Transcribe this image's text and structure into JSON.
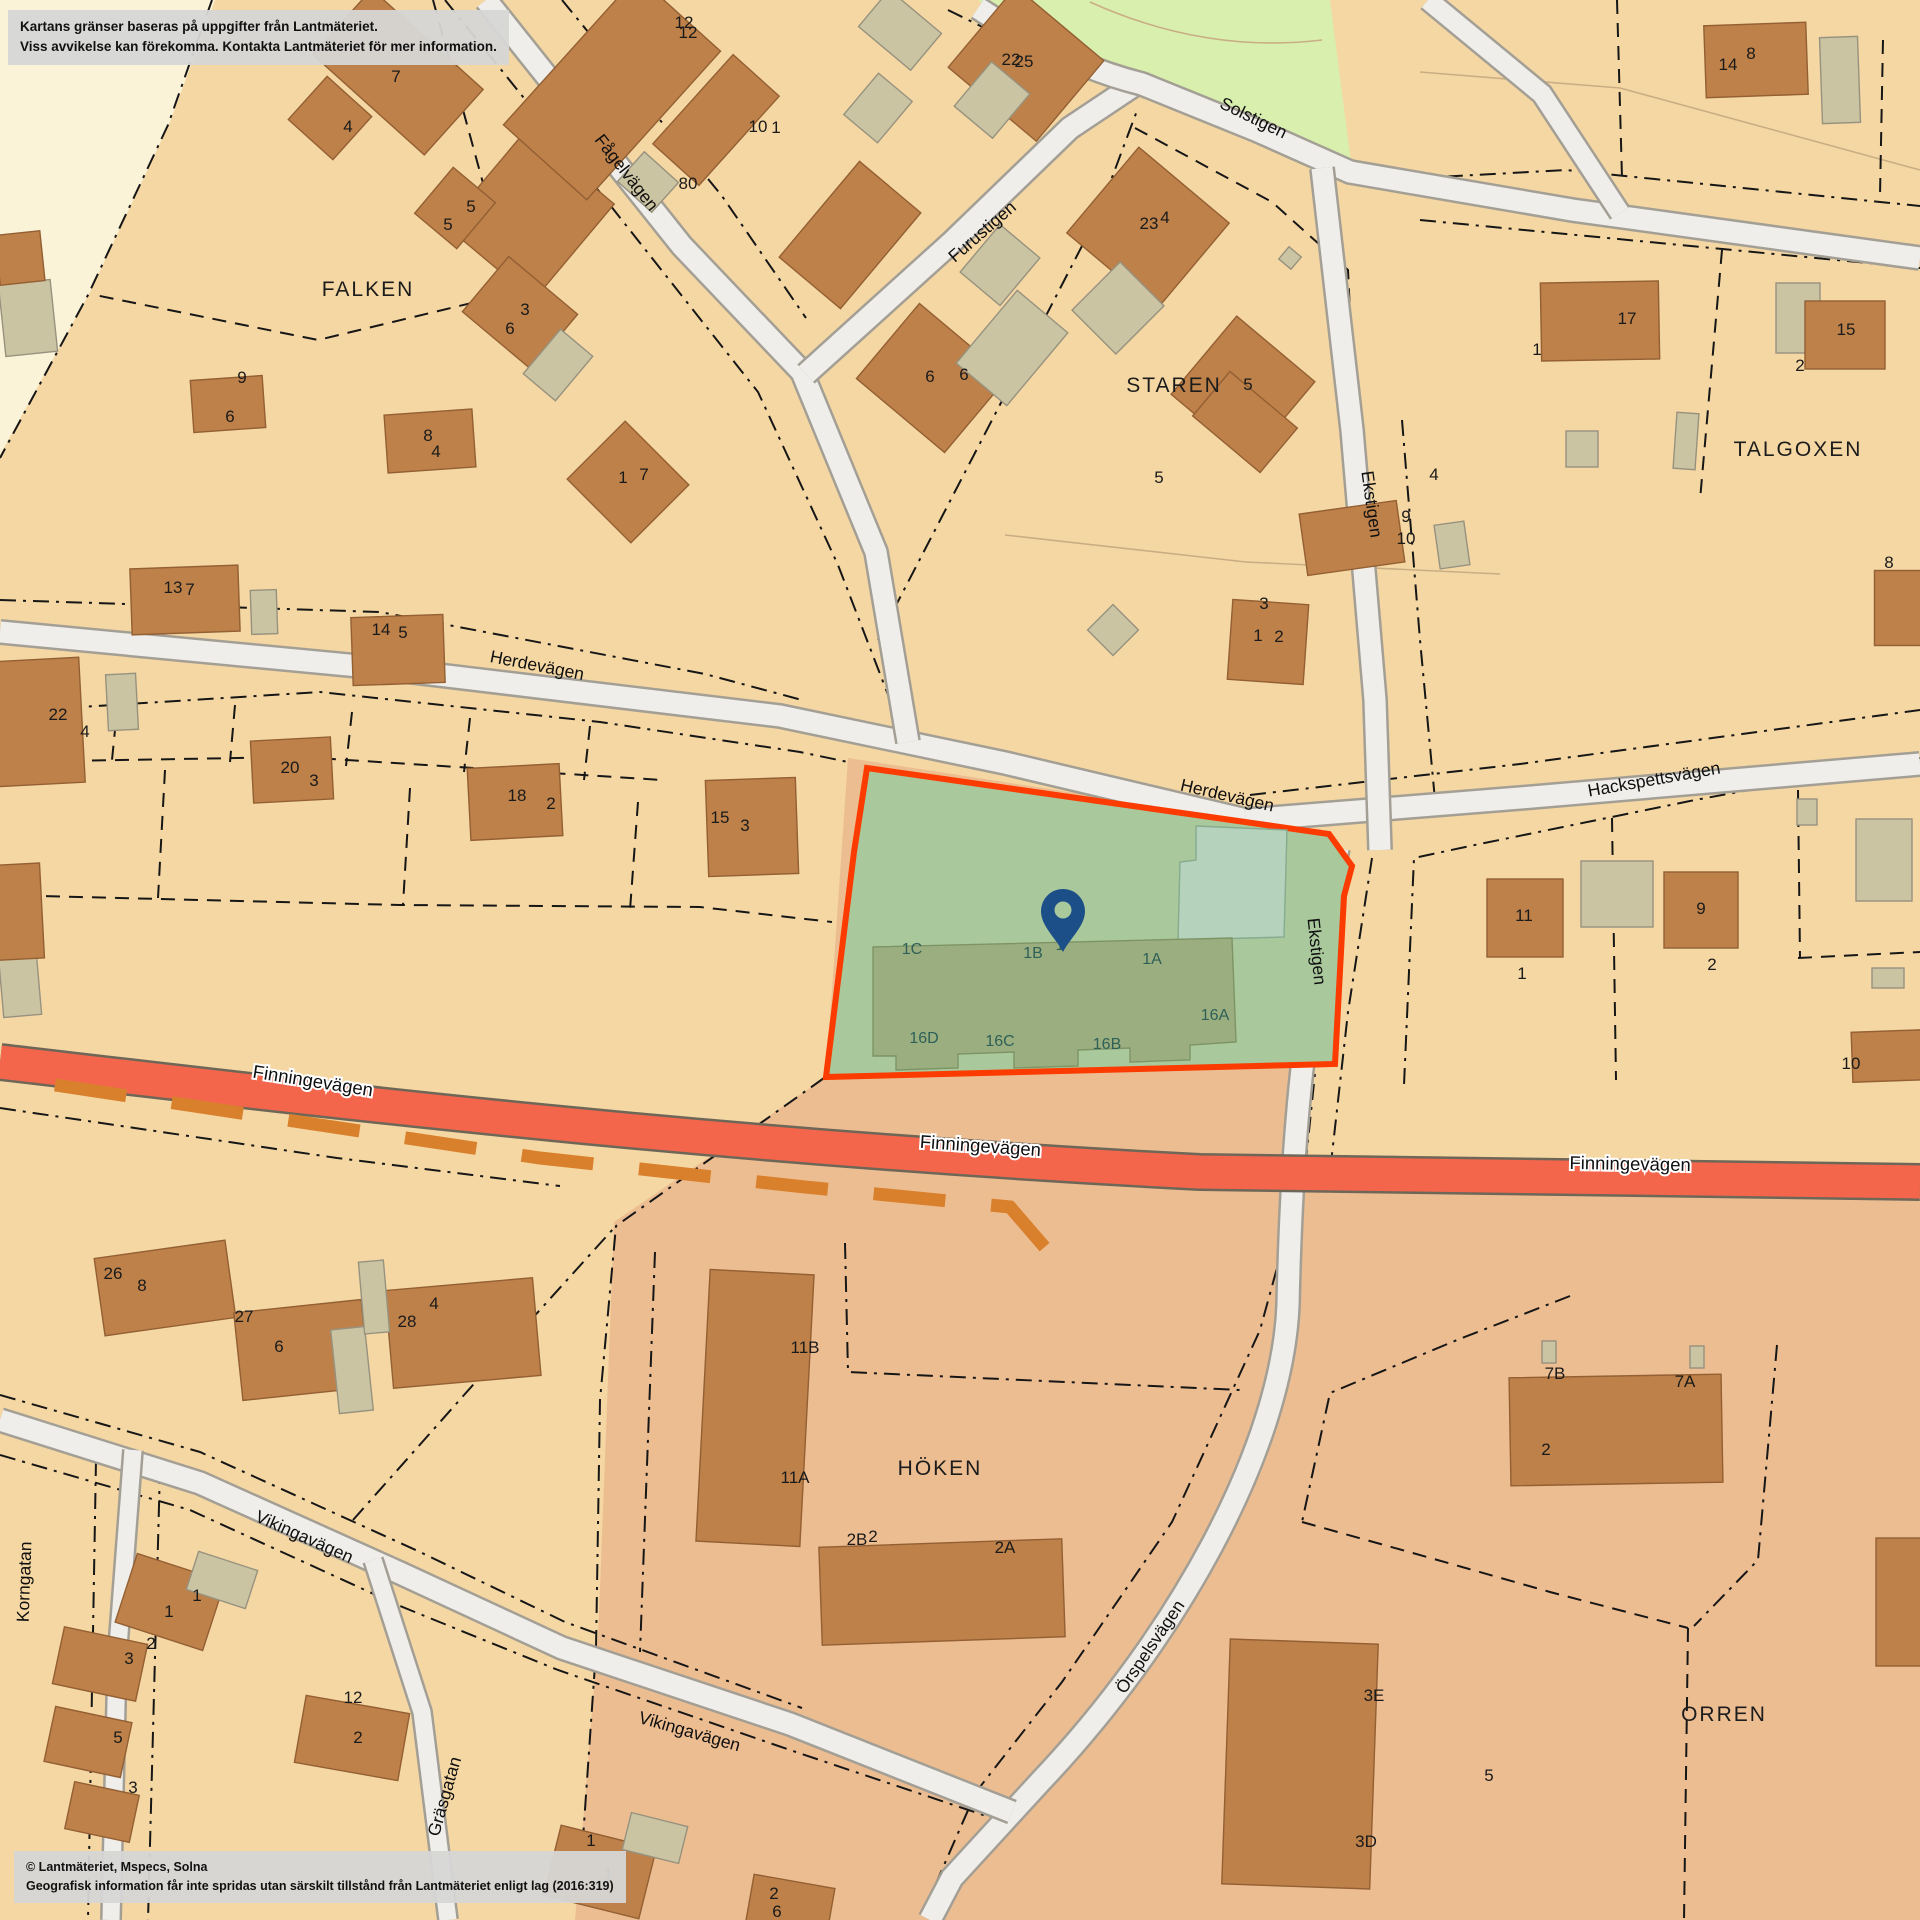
{
  "overlays": {
    "disclaimer_line1": "Kartans gränser baseras på uppgifter från Lantmäteriet.",
    "disclaimer_line2": "Viss avvikelse kan förekomma. Kontakta Lantmäteriet för mer information.",
    "copyright_line1": "© Lantmäteriet, Mspecs, Solna",
    "copyright_line2": "Geografisk information får inte spridas utan särskilt tillstånd från Lantmäteriet enligt lag (2016:319)"
  },
  "colors": {
    "tan": "#f5d7a3",
    "cream": "#fbf3d8",
    "park": "#d9efad",
    "salmon": "#edbd92",
    "parcel_green": "#a9c89c",
    "teal": "#b5d2bd",
    "subject_building": "#9aae80",
    "subject_building_stroke": "#7e9465",
    "orange_border": "#fb3b00",
    "house": "#bd8149",
    "house_stroke": "#935f33",
    "shed": "#cac4a2",
    "shed_stroke": "#97927f",
    "road_fill": "#efeeeb",
    "road_casing": "#a49f95",
    "finninge_fill": "#f3664c",
    "finninge_casing": "#6e6758",
    "trail": "#d9802c",
    "boundary": "#161616",
    "thin_line": "#c9ae85",
    "pin": "#1c4e88"
  },
  "regions": [
    {
      "name": "cream-area",
      "d": "M0,0 L215,0 L170,122 L90,292 L0,455 Z",
      "fill": "cream"
    },
    {
      "name": "park-area",
      "d": "M978,0 L1330,0 L1352,170 L1260,132 L1145,86 Q1040,55 978,0 Z",
      "fill": "park"
    },
    {
      "name": "salmon-area",
      "d": "M848,758 L1160,806 L1235,878 L1290,1010 L1308,1160 L1920,1176 L1920,1920 L575,1920 L598,1640 L614,1222 L826,1077 Z",
      "fill": "salmon"
    }
  ],
  "thin_lines": [
    {
      "d": "M1090,2 Q1205,54 1322,40"
    },
    {
      "d": "M1005,535 L1246,562 L1500,574"
    },
    {
      "d": "M1420,72 L1620,88 L1920,170"
    }
  ],
  "boundaries_dashdot": [
    "M212,0 L168,125 L88,295 L0,458",
    "M445,0 L610,205 L758,392 L838,565 L892,705",
    "M562,0 L722,196 L806,318",
    "M0,600 L380,612 L705,674 L802,700",
    "M0,712 L320,692 L600,722 L800,752 L848,762",
    "M806,368 L950,240 L1068,126",
    "M878,640 L1005,395 L1098,215 L1138,108",
    "M948,10 L1058,64 L1146,94 L1256,140 L1348,182",
    "M1348,182 L1566,170 L1920,206",
    "M1420,220 L1920,268",
    "M1322,178 L1348,430 L1370,700 L1378,842",
    "M1402,420 L1420,640 L1435,800",
    "M1250,795 L1520,764 L1920,710",
    "M1920,758 L1690,801 L1470,846 L1414,858 L1404,1085",
    "M1344,855 L1322,1005 L1305,1170",
    "M1372,858 L1348,1012 L1330,1172",
    "M1294,1206 L1260,1330 L1172,1522 L1062,1682 L976,1792 L920,1920",
    "M1570,1296 L1457,1340 L1330,1393 L1302,1522",
    "M1777,1345 L1758,1560 L1694,1626",
    "M0,1108 L337,1158 L560,1186",
    "M0,1395 L200,1452 L420,1552 L565,1622 L802,1708",
    "M0,1455 L190,1510 L400,1606 L558,1670 L790,1750 L1010,1824",
    "M353,1520 L520,1332 L614,1228",
    "M824,1078 L616,1226 L600,1400 L596,1650 L580,1882",
    "M655,1252 L640,1652",
    "M845,1243 L848,1372 L1240,1390",
    "M160,1468 L148,1920",
    "M96,1460 L88,1920"
  ],
  "boundaries_dash": [
    "M433,0 L513,293 L318,340 L95,295",
    "M1135,128 L1272,202 L1348,270 L1356,440",
    "M1617,0 L1622,178",
    "M1883,40 L1880,195",
    "M1722,250 L1700,500",
    "M0,762 L300,757 L662,780",
    "M118,700 L112,760",
    "M235,705 L230,762",
    "M352,712 L346,766",
    "M470,718 L464,772",
    "M590,726 L584,780",
    "M0,895 L400,905 L700,907 L832,922",
    "M165,770 L158,898",
    "M410,788 L403,905",
    "M638,802 L630,910",
    "M1302,1522 L1427,1557 L1550,1592 L1688,1628",
    "M1688,1628 L1684,1920",
    "M1612,818 L1616,1080",
    "M1798,790 L1800,958",
    "M1798,958 L1920,952"
  ],
  "roads": [
    {
      "name": "road-herdevagen",
      "d": "M0,632 L380,668 L780,716 L1005,763 L1246,820",
      "w": 21
    },
    {
      "name": "road-hackspettsvagen",
      "d": "M1246,820 L1520,798 L1920,764",
      "w": 21
    },
    {
      "name": "road-fagelvagen",
      "d": "M486,0 L682,246 L802,372 L876,552 L908,742",
      "w": 21
    },
    {
      "name": "road-furustigen",
      "d": "M806,374 L952,242 L1070,128 L1142,80",
      "w": 21
    },
    {
      "name": "road-solstigen",
      "d": "M978,8 Q1062,64 1142,84 L1258,131 L1350,172 L1572,210 L1920,258",
      "w": 21
    },
    {
      "name": "road-solstigen-ne",
      "d": "M1428,0 L1542,94 L1620,213",
      "w": 19
    },
    {
      "name": "road-ekstigen",
      "d": "M1322,168 L1352,430 L1375,700 L1380,850",
      "w": 21
    },
    {
      "name": "road-orrspelsvagen",
      "d": "M1338,848 C1305,1010 1292,1120 1288,1305 C1282,1450 1175,1640 1040,1782 L952,1878 L930,1920",
      "w": 21
    },
    {
      "name": "road-vikingavagen",
      "d": "M0,1420 L200,1483 L400,1573 L562,1648 L790,1724 L1012,1812",
      "w": 21
    },
    {
      "name": "road-korngatan",
      "d": "M133,1450 L117,1660 L111,1920",
      "w": 17
    },
    {
      "name": "road-grasgatan",
      "d": "M373,1560 L422,1712 L448,1920",
      "w": 17
    }
  ],
  "main_road": {
    "name": "road-finningevagen",
    "d": "M0,1062 C310,1098 700,1146 1200,1172 L1920,1182",
    "w": 33
  },
  "trail": {
    "name": "trail-dashed",
    "d": "M55,1085 L300,1122 L540,1158 L805,1187 L1010,1207 L1060,1265",
    "w": 13,
    "dash": "72 46"
  },
  "buildings": [
    [
      398,
      72,
      150,
      88,
      42,
      "h"
    ],
    [
      330,
      118,
      60,
      58,
      42,
      "h"
    ],
    [
      530,
      215,
      115,
      125,
      40,
      "h"
    ],
    [
      455,
      208,
      55,
      60,
      40,
      "h"
    ],
    [
      520,
      313,
      90,
      72,
      40,
      "h"
    ],
    [
      558,
      365,
      42,
      58,
      40,
      "s"
    ],
    [
      228,
      404,
      72,
      52,
      -4,
      "h"
    ],
    [
      430,
      441,
      88,
      58,
      -4,
      "h"
    ],
    [
      628,
      482,
      90,
      82,
      45,
      "h"
    ],
    [
      612,
      88,
      112,
      200,
      42,
      "h"
    ],
    [
      716,
      120,
      62,
      120,
      42,
      "h"
    ],
    [
      648,
      182,
      46,
      40,
      42,
      "s"
    ],
    [
      28,
      318,
      52,
      72,
      -6,
      "s"
    ],
    [
      20,
      258,
      45,
      50,
      -6,
      "h"
    ],
    [
      20,
      985,
      38,
      62,
      -5,
      "s"
    ],
    [
      12,
      912,
      60,
      95,
      -3,
      "h"
    ],
    [
      1026,
      64,
      115,
      105,
      40,
      "h"
    ],
    [
      992,
      100,
      50,
      58,
      40,
      "s"
    ],
    [
      900,
      30,
      68,
      48,
      40,
      "s"
    ],
    [
      878,
      108,
      44,
      54,
      40,
      "s"
    ],
    [
      850,
      235,
      80,
      125,
      40,
      "h"
    ],
    [
      932,
      378,
      115,
      98,
      40,
      "h"
    ],
    [
      1000,
      265,
      52,
      62,
      40,
      "s"
    ],
    [
      1012,
      348,
      66,
      95,
      40,
      "s"
    ],
    [
      1148,
      228,
      118,
      112,
      40,
      "h"
    ],
    [
      1118,
      308,
      62,
      68,
      45,
      "s"
    ],
    [
      1243,
      388,
      102,
      102,
      40,
      "h"
    ],
    [
      1290,
      258,
      16,
      16,
      40,
      "s"
    ],
    [
      1756,
      60,
      102,
      72,
      -2,
      "h"
    ],
    [
      1840,
      80,
      38,
      86,
      -2,
      "s"
    ],
    [
      1600,
      321,
      118,
      78,
      -1,
      "h"
    ],
    [
      1798,
      318,
      44,
      70,
      0,
      "s"
    ],
    [
      1845,
      335,
      80,
      68,
      0,
      "h"
    ],
    [
      1582,
      449,
      32,
      36,
      0,
      "s"
    ],
    [
      1686,
      441,
      22,
      56,
      4,
      "s"
    ],
    [
      1352,
      538,
      98,
      62,
      -8,
      "h"
    ],
    [
      1452,
      545,
      30,
      44,
      -8,
      "s"
    ],
    [
      1245,
      422,
      88,
      58,
      40,
      "h"
    ],
    [
      1268,
      642,
      76,
      80,
      4,
      "h"
    ],
    [
      1113,
      630,
      36,
      36,
      45,
      "s"
    ],
    [
      1902,
      608,
      55,
      75,
      0,
      "h"
    ],
    [
      1525,
      918,
      76,
      78,
      0,
      "h"
    ],
    [
      1617,
      894,
      72,
      66,
      0,
      "s"
    ],
    [
      1701,
      910,
      74,
      76,
      0,
      "h"
    ],
    [
      1807,
      812,
      20,
      26,
      0,
      "s"
    ],
    [
      1884,
      860,
      56,
      82,
      0,
      "s"
    ],
    [
      1888,
      978,
      32,
      20,
      0,
      "s"
    ],
    [
      1888,
      1056,
      72,
      50,
      -2,
      "h"
    ],
    [
      185,
      600,
      108,
      66,
      -2,
      "h"
    ],
    [
      264,
      612,
      26,
      44,
      -2,
      "s"
    ],
    [
      398,
      650,
      92,
      68,
      -2,
      "h"
    ],
    [
      752,
      827,
      90,
      96,
      -2,
      "h"
    ],
    [
      515,
      802,
      92,
      72,
      -3,
      "h"
    ],
    [
      292,
      770,
      80,
      62,
      -3,
      "h"
    ],
    [
      38,
      722,
      88,
      125,
      -3,
      "h"
    ],
    [
      122,
      702,
      30,
      56,
      -3,
      "s"
    ],
    [
      165,
      1288,
      132,
      78,
      -8,
      "h"
    ],
    [
      302,
      1350,
      128,
      88,
      -6,
      "h"
    ],
    [
      352,
      1370,
      34,
      84,
      -6,
      "s"
    ],
    [
      463,
      1333,
      148,
      98,
      -5,
      "h"
    ],
    [
      374,
      1297,
      25,
      72,
      -5,
      "s"
    ],
    [
      170,
      1602,
      92,
      72,
      18,
      "h"
    ],
    [
      222,
      1580,
      62,
      40,
      18,
      "s"
    ],
    [
      100,
      1664,
      85,
      58,
      12,
      "h"
    ],
    [
      88,
      1742,
      78,
      56,
      12,
      "h"
    ],
    [
      102,
      1812,
      66,
      48,
      12,
      "h"
    ],
    [
      352,
      1738,
      105,
      68,
      10,
      "h"
    ],
    [
      600,
      1872,
      98,
      72,
      14,
      "h"
    ],
    [
      655,
      1838,
      58,
      38,
      14,
      "s"
    ],
    [
      790,
      1907,
      82,
      52,
      10,
      "h"
    ],
    [
      755,
      1408,
      104,
      272,
      3,
      "h"
    ],
    [
      942,
      1592,
      243,
      98,
      -2,
      "h"
    ],
    [
      1616,
      1430,
      212,
      108,
      -1,
      "h"
    ],
    [
      1549,
      1352,
      14,
      22,
      0,
      "s"
    ],
    [
      1697,
      1357,
      14,
      22,
      0,
      "s"
    ],
    [
      1300,
      1764,
      148,
      245,
      2,
      "h"
    ],
    [
      1899,
      1602,
      46,
      128,
      0,
      "h"
    ]
  ],
  "subject_property": {
    "outline_points": "867,768 1329,834 1352,866 1344,896 1335,1064 826,1077 854,852",
    "teal_points": "1196,826 1287,830 1284,937 1178,940 1180,862 1196,860",
    "building_points": "873,947 1232,938 1236,1042 1190,1045 1190,1060 1130,1062 1130,1048 1078,1050 1078,1066 1014,1068 1014,1052 958,1054 958,1068 896,1070 896,1056 873,1056",
    "unit_labels": [
      [
        "1C",
        912,
        954
      ],
      [
        "1B",
        1033,
        958
      ],
      [
        "1",
        1060,
        950
      ],
      [
        "1A",
        1152,
        964
      ],
      [
        "16A",
        1215,
        1020
      ],
      [
        "16D",
        924,
        1043
      ],
      [
        "16C",
        1000,
        1046
      ],
      [
        "16B",
        1107,
        1049
      ]
    ],
    "pin": {
      "x": 1063,
      "y": 952
    }
  },
  "street_labels": [
    [
      "Fågelvägen",
      622,
      176,
      52,
      0
    ],
    [
      "Furustigen",
      986,
      236,
      -41,
      0
    ],
    [
      "Solstigen",
      1251,
      123,
      26,
      0
    ],
    [
      "Ekstigen",
      1366,
      505,
      82,
      0
    ],
    [
      "Ekstigen",
      1311,
      952,
      84,
      0
    ],
    [
      "Herdevägen",
      536,
      671,
      11,
      0
    ],
    [
      "Herdevägen",
      1226,
      801,
      13,
      0
    ],
    [
      "Hackspettsvägen",
      1655,
      785,
      -10,
      0
    ],
    [
      "Finningevägen",
      312,
      1087,
      9,
      1
    ],
    [
      "Finningevägen",
      980,
      1152,
      4,
      1
    ],
    [
      "Finningevägen",
      1630,
      1170,
      1,
      1
    ],
    [
      "Vikingavägen",
      302,
      1542,
      24,
      0
    ],
    [
      "Vikingavägen",
      688,
      1737,
      16,
      0
    ],
    [
      "Korngatan",
      30,
      1582,
      -88,
      0
    ],
    [
      "Gräsgatan",
      450,
      1798,
      -74,
      0
    ],
    [
      "Örspelsvägen",
      1155,
      1650,
      -56,
      0
    ]
  ],
  "district_labels": [
    [
      "FALKEN",
      368,
      296
    ],
    [
      "STAREN",
      1174,
      392
    ],
    [
      "TALGOXEN",
      1798,
      456
    ],
    [
      "HÖKEN",
      940,
      1475
    ],
    [
      "ORREN",
      1724,
      1721
    ]
  ],
  "house_numbers": [
    [
      "7",
      396,
      82
    ],
    [
      "4",
      348,
      132
    ],
    [
      "5",
      471,
      212
    ],
    [
      "5",
      448,
      230
    ],
    [
      "3",
      525,
      315
    ],
    [
      "6",
      510,
      334
    ],
    [
      "9",
      242,
      383
    ],
    [
      "6",
      230,
      422
    ],
    [
      "8",
      428,
      441
    ],
    [
      "4",
      436,
      457
    ],
    [
      "1",
      623,
      483
    ],
    [
      "7",
      644,
      480
    ],
    [
      "12",
      684,
      28
    ],
    [
      "12",
      688,
      38
    ],
    [
      "10",
      758,
      132
    ],
    [
      "1",
      776,
      133
    ],
    [
      "80",
      688,
      189
    ],
    [
      "22",
      1011,
      65
    ],
    [
      "25",
      1024,
      67
    ],
    [
      "23",
      1149,
      229
    ],
    [
      "4",
      1165,
      223
    ],
    [
      "6",
      930,
      382
    ],
    [
      "6",
      964,
      380
    ],
    [
      "5",
      1248,
      390
    ],
    [
      "5",
      1159,
      483
    ],
    [
      "3",
      1264,
      609
    ],
    [
      "1",
      1258,
      641
    ],
    [
      "2",
      1279,
      642
    ],
    [
      "14",
      1728,
      70
    ],
    [
      "8",
      1751,
      59
    ],
    [
      "17",
      1627,
      324
    ],
    [
      "1",
      1537,
      355
    ],
    [
      "15",
      1846,
      335
    ],
    [
      "2",
      1800,
      371
    ],
    [
      "4",
      1434,
      480
    ],
    [
      "8",
      1889,
      568
    ],
    [
      "9",
      1406,
      522
    ],
    [
      "10",
      1406,
      544
    ],
    [
      "11",
      1524,
      921
    ],
    [
      "1",
      1522,
      979
    ],
    [
      "9",
      1701,
      914
    ],
    [
      "2",
      1712,
      970
    ],
    [
      "10",
      1851,
      1069
    ],
    [
      "13",
      173,
      593
    ],
    [
      "7",
      190,
      595
    ],
    [
      "14",
      381,
      635
    ],
    [
      "5",
      403,
      638
    ],
    [
      "15",
      720,
      823
    ],
    [
      "3",
      745,
      831
    ],
    [
      "22",
      58,
      720
    ],
    [
      "4",
      85,
      737
    ],
    [
      "20",
      290,
      773
    ],
    [
      "3",
      314,
      786
    ],
    [
      "18",
      517,
      801
    ],
    [
      "2",
      551,
      809
    ],
    [
      "26",
      113,
      1279
    ],
    [
      "8",
      142,
      1291
    ],
    [
      "27",
      244,
      1322
    ],
    [
      "6",
      279,
      1352
    ],
    [
      "28",
      407,
      1327
    ],
    [
      "4",
      434,
      1309
    ],
    [
      "1",
      197,
      1601
    ],
    [
      "1",
      169,
      1617
    ],
    [
      "2",
      151,
      1649
    ],
    [
      "3",
      129,
      1664
    ],
    [
      "5",
      118,
      1743
    ],
    [
      "3",
      133,
      1793
    ],
    [
      "12",
      353,
      1703
    ],
    [
      "2",
      358,
      1743
    ],
    [
      "1",
      591,
      1846
    ],
    [
      "1",
      608,
      1879
    ],
    [
      "2",
      774,
      1899
    ],
    [
      "6",
      777,
      1917
    ],
    [
      "11B",
      805,
      1353
    ],
    [
      "11A",
      795,
      1483
    ],
    [
      "2B",
      857,
      1545
    ],
    [
      "2",
      873,
      1542
    ],
    [
      "2A",
      1005,
      1553
    ],
    [
      "7B",
      1555,
      1379
    ],
    [
      "7A",
      1685,
      1387
    ],
    [
      "2",
      1546,
      1455
    ],
    [
      "3E",
      1374,
      1701
    ],
    [
      "3D",
      1366,
      1847
    ],
    [
      "5",
      1489,
      1781
    ]
  ]
}
